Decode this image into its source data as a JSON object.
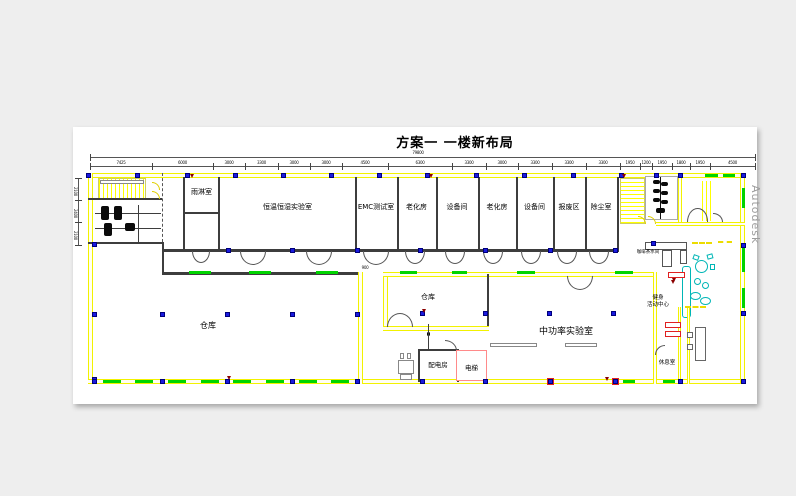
{
  "title": "方案一  一楼新布局",
  "watermark": "Autodesk",
  "rooms": {
    "rain_room": "雨淋室",
    "climate_lab": "恒温恒湿实验室",
    "emc_lab": "EMC测试室",
    "aging_room_1": "老化房",
    "equipment_room_1": "设备间",
    "aging_room_2": "老化房",
    "equipment_room_2": "设备间",
    "scrap_area": "报废区",
    "dust_room": "除尘室",
    "warehouse_main": "仓库",
    "warehouse_small": "仓库",
    "mid_power_lab": "中功率实验室",
    "power_distribution": "配电房",
    "elevator": "电梯",
    "coffee_pantry": "咖啡茶水间",
    "fitness_center_line1": "健身",
    "fitness_center_line2": "活动中心",
    "lounge": "休息室"
  },
  "dimensions": {
    "top_total": "79800",
    "top_segments": [
      "7425",
      "6000",
      "3000",
      "3300",
      "3000",
      "3000",
      "4500",
      "6300",
      "3300",
      "3000",
      "3300",
      "3300",
      "3300",
      "1950",
      "1200",
      "1950",
      "1800",
      "1950",
      "4500"
    ],
    "left_segments": [
      "2100",
      "2400",
      "2100"
    ],
    "corridor_dim": "900"
  },
  "colors": {
    "wall_yellow": "#f2f200",
    "window_green": "#00d400",
    "column_blue": "#1a1ae0",
    "marker_red": "#e02020",
    "elevator_pink": "#ff8a8a",
    "furniture_cyan": "#00b6b6",
    "wall_dark": "#3d3d3d",
    "watermark_gray": "#9c9c9c"
  }
}
